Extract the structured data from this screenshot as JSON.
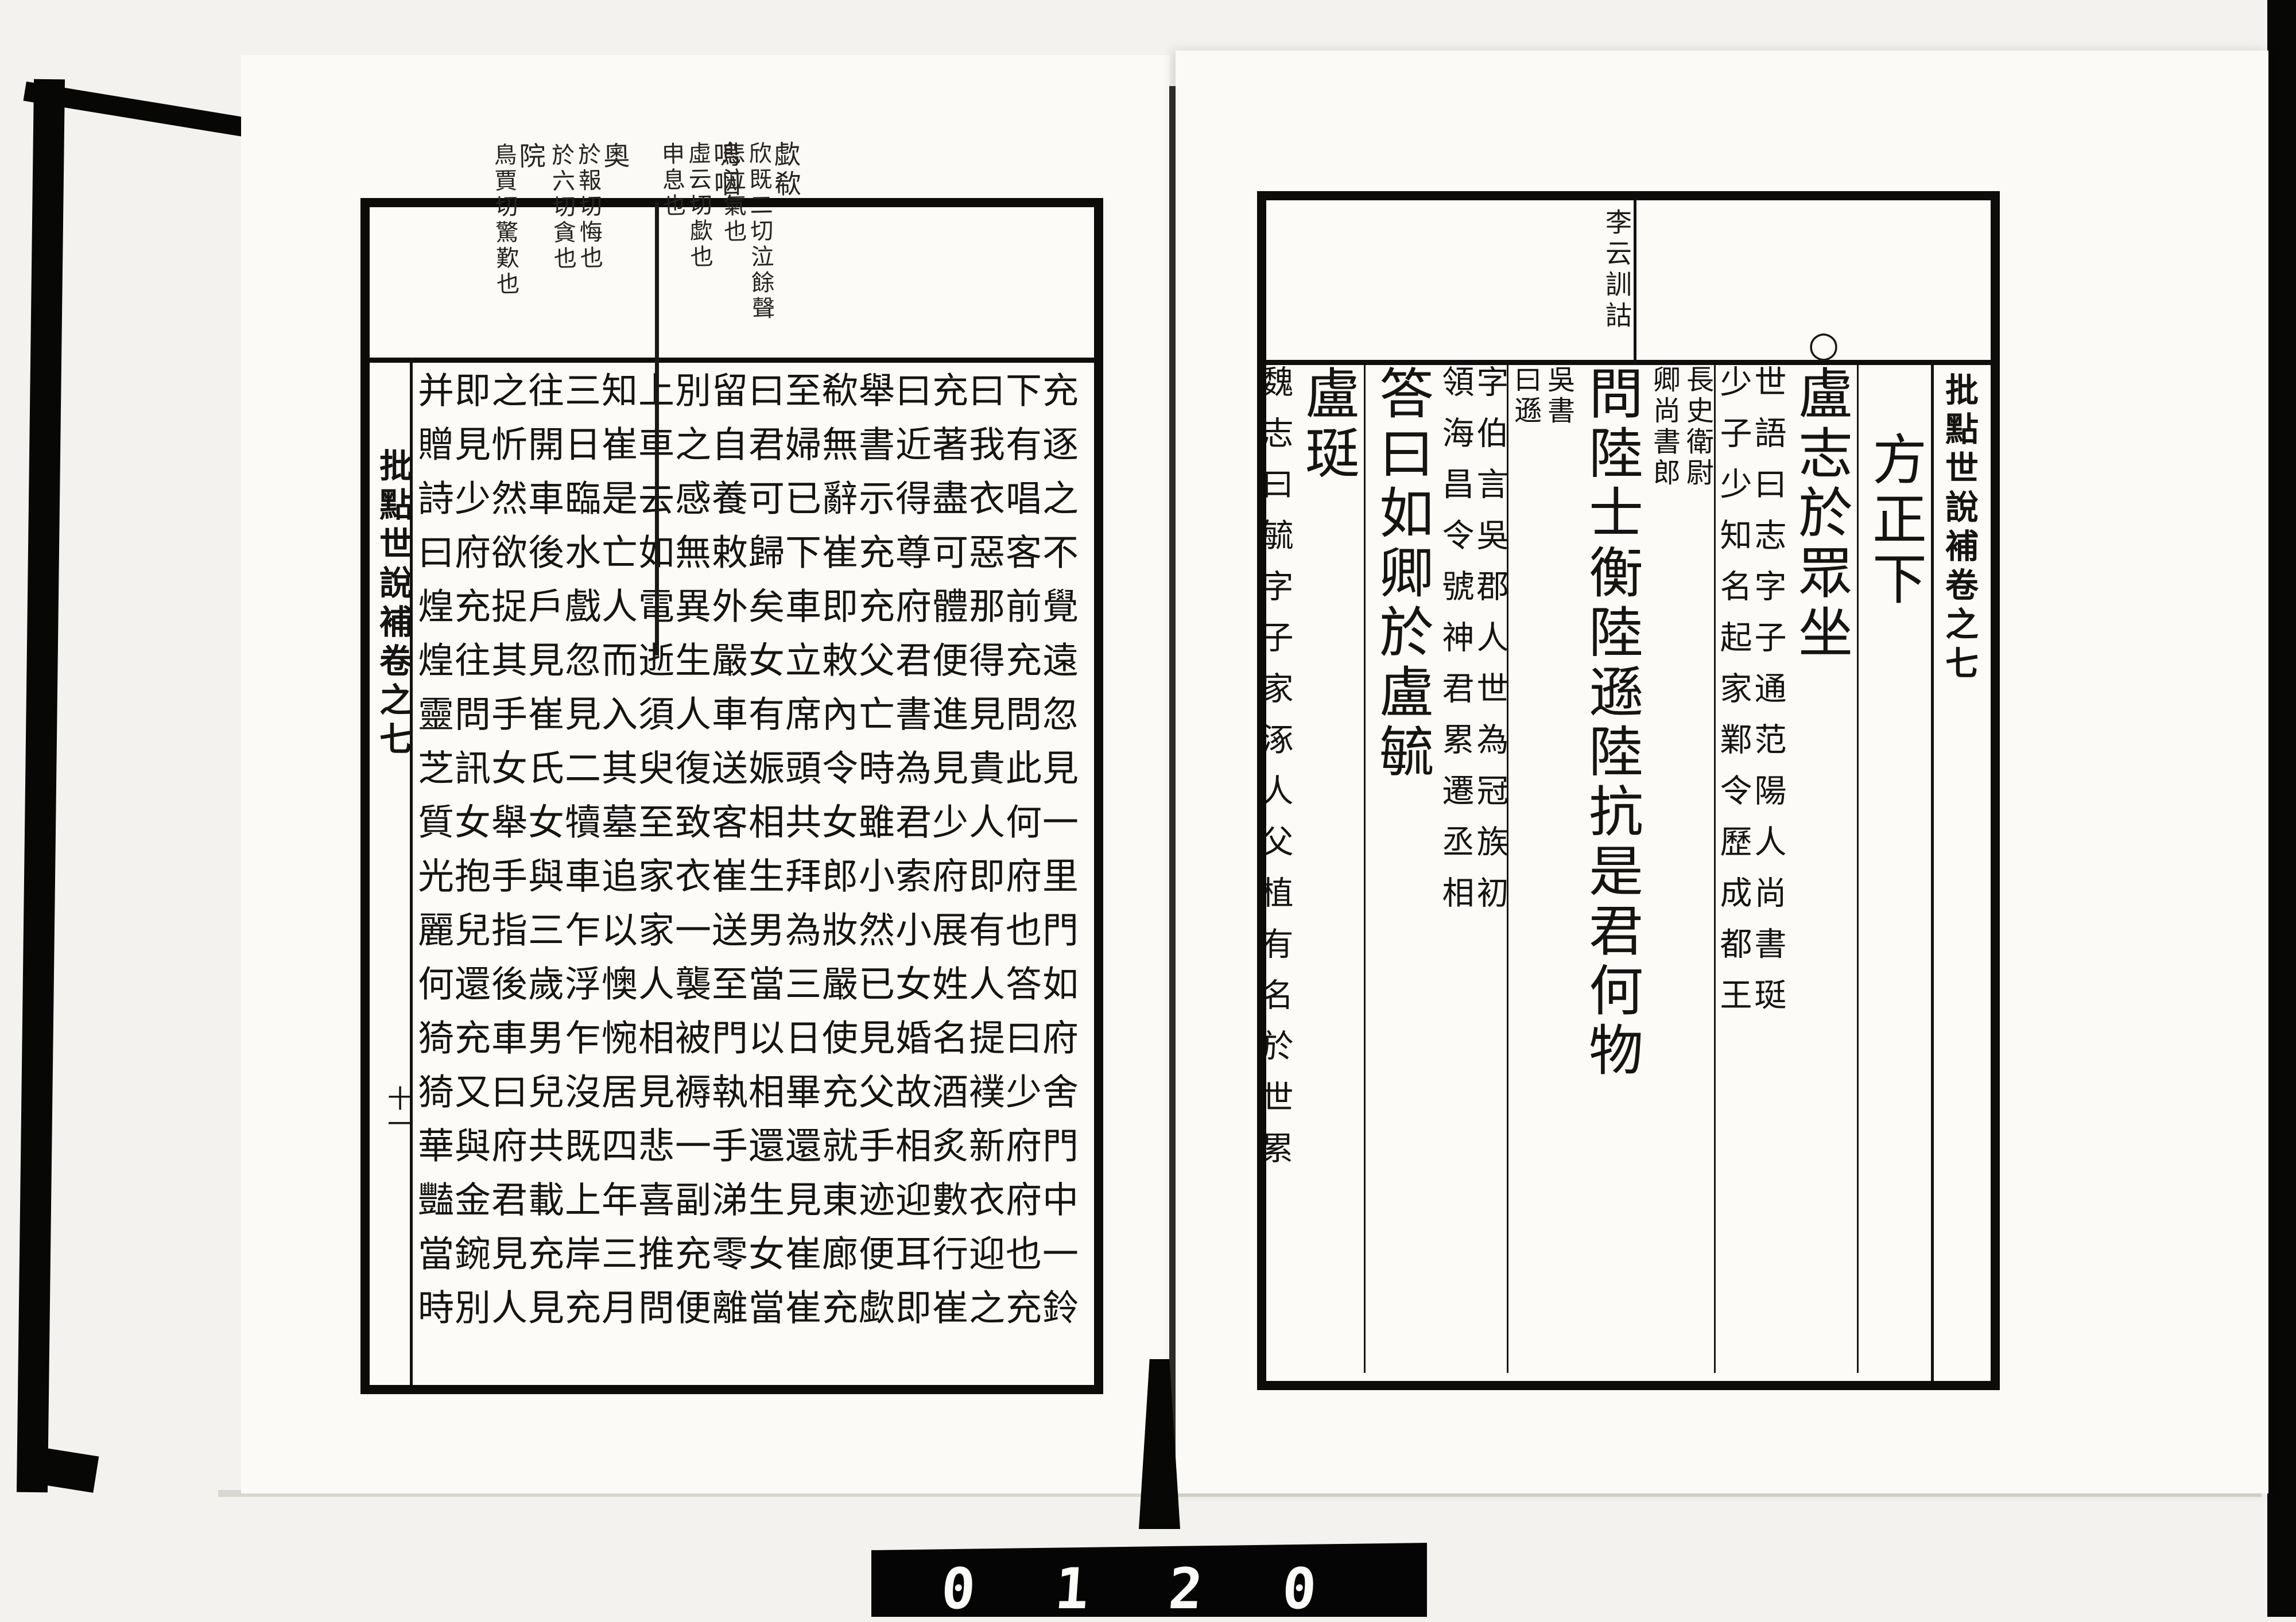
{
  "film_counter": {
    "digits": "0 1 2 0"
  },
  "left_page": {
    "banxin_title": "批點世說補卷之七",
    "leaf_number": "十一",
    "margin_annotations": [
      {
        "lead": "歔欷",
        "cols": [
          "欣既二切泣餘聲",
          "悲泣氣也"
        ]
      },
      {
        "lead": "嗚咽",
        "cols": [
          "虛云切歔也",
          "申息也"
        ]
      },
      {
        "lead": "奧",
        "cols": [
          "於報切悔也",
          "於六切貪也"
        ]
      },
      {
        "lead": "院",
        "cols": [
          "鳥賈切驚歎也"
        ]
      }
    ],
    "columns": [
      "充逐之不覺遠忽見一里門如府舍門中一鈴",
      "下有唱客前充問此何府也答曰少府府也充",
      "曰我衣惡那得見貴人即有人提襆新衣迎之",
      "充著盡可體便進見少府展姓名酒炙數行崔",
      "曰近得尊府君書為君索小女婚故相迎耳即",
      "舉書示充充父亡時雖小然已見父手迹便歔",
      "欷無辭崔即敕內令女郎妝嚴使充就東廊充",
      "至婦已下車立席頭共拜為三日畢還見崔崔",
      "曰君可歸矣女有娠相生男當以相還生女當",
      "留自養敕外嚴車送客崔送至門執手涕零離",
      "別之感無異生人復致衣一襲被褥一副充便",
      "上車去如電逝須臾至家家人相見悲喜推問",
      "知崔是亡人而入其墓追以懊惋居四年三月",
      "三日臨水戲忽見二犢車乍浮乍沒既上岸充",
      "往開車後戶見崔氏女與三歲男兒共載充見",
      "之忻然欲捉其手女舉手指後車曰府君見人",
      "即見少府充往問訊女抱兒還充又與金鋺別",
      "并贈詩曰煌煌靈芝質光麗何猗猗華豔當時"
    ]
  },
  "right_page": {
    "banxin_title": "批點世說補卷之七",
    "margin_annotation": "李云訓詁",
    "section_mark": "○",
    "columns": [
      {
        "segments": [
          {
            "type": "main",
            "text": "方正下",
            "indent": true
          }
        ]
      },
      {
        "segments": [
          {
            "type": "main",
            "text": "盧志於眾坐"
          },
          {
            "type": "dual",
            "right": "世語曰志字子通范陽人尚書珽",
            "left": "少子少知名起家鄴令歷成都王"
          }
        ]
      },
      {
        "segments": [
          {
            "type": "dual",
            "right": "長史衛尉",
            "left": "卿尚書郎",
            "compact": true
          },
          {
            "type": "main",
            "text": "問陸士衡陸遜陸抗是君何物"
          },
          {
            "type": "dual",
            "right": "吳書",
            "left": "曰遜",
            "compact": true
          }
        ]
      },
      {
        "segments": [
          {
            "type": "dual",
            "right": "字伯言吳郡人世為冠族初",
            "left": "領海昌令號神君累遷丞相"
          },
          {
            "type": "main",
            "text": "答曰如卿於盧毓"
          }
        ]
      },
      {
        "segments": [
          {
            "type": "main",
            "text": "盧珽"
          },
          {
            "type": "dual",
            "right": "魏志曰毓字子家涿人父植有名於世累",
            "left": "遷吏部郎尚書選舉先性行而後言才進"
          }
        ]
      },
      {
        "segments": [
          {
            "type": "dual",
            "right": "司空珽咸熙中為泰山",
            "left": "太守字子笏位至尚書"
          },
          {
            "type": "main",
            "text": "士龍失色既出戶謂兄"
          }
        ]
      },
      {
        "segments": [
          {
            "type": "main",
            "text": "曰何至如此彼容不相知也士衡正色曰我父"
          }
        ]
      },
      {
        "segments": [
          {
            "type": "main",
            "text": "祖名播海內寧有不知鬼子敢爾"
          },
          {
            "type": "dual",
            "right": "孔氏志怪曰",
            "left": "盧充者范陽"
          }
        ]
      },
      {
        "segments": [
          {
            "type": "dual",
            "right": "人家西三十里有崔少府墓充先冬至一日出",
            "left": "宅西獵戲見一獐舉弓而射即中之獐倒而復起"
          }
        ]
      }
    ]
  }
}
